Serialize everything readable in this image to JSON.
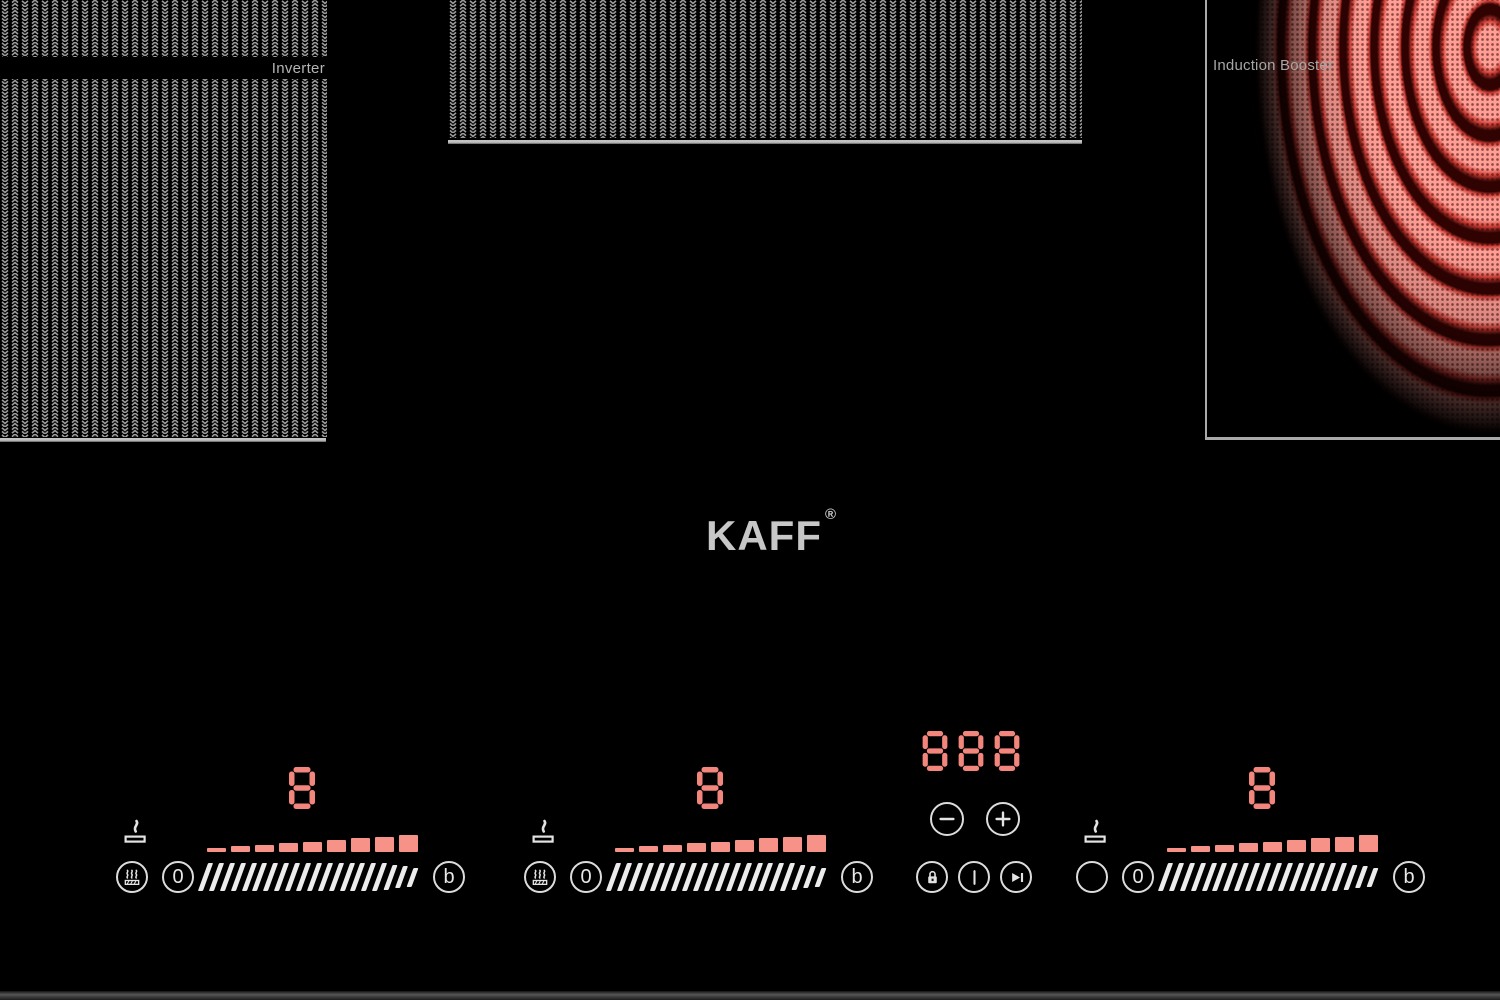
{
  "brand": {
    "name": "KAFF",
    "registered": "®"
  },
  "labels": {
    "inverter": "Inverter",
    "induction_booster": "Induction Booster"
  },
  "zones": [
    {
      "name": "front-left",
      "display": "8",
      "power_bars_lit": 9,
      "power_bars_total": 9,
      "off_label": "0",
      "boost_label": "b",
      "function_icon": "keep-warm",
      "residual_heat_indicator": true
    },
    {
      "name": "front-center",
      "display": "8",
      "power_bars_lit": 9,
      "power_bars_total": 9,
      "off_label": "0",
      "boost_label": "b",
      "function_icon": "keep-warm",
      "residual_heat_indicator": true
    },
    {
      "name": "front-right",
      "display": "8",
      "power_bars_lit": 9,
      "power_bars_total": 9,
      "off_label": "0",
      "boost_label": "b",
      "function_icon": "none",
      "residual_heat_indicator": true
    }
  ],
  "timer": {
    "display": "888"
  },
  "icons": {
    "zone_function": "keep-warm-icon",
    "residual_heat": "residual-heat-icon",
    "timer_minus": "minus-icon",
    "timer_plus": "plus-icon",
    "lock": "lock-icon",
    "power": "power-icon",
    "pause_play": "pause-play-icon"
  },
  "colors": {
    "accent": "#f2857c",
    "bars": "#f79289",
    "glow_bright": "#ff9e95",
    "glow_mid": "#cf4038",
    "glow_dark": "#2e0302",
    "texture_gray": "#9c9c9c",
    "label_gray": "#a6a6a6",
    "control_stroke": "#dcdcdc",
    "logo_gray": "#c7c7c7"
  }
}
